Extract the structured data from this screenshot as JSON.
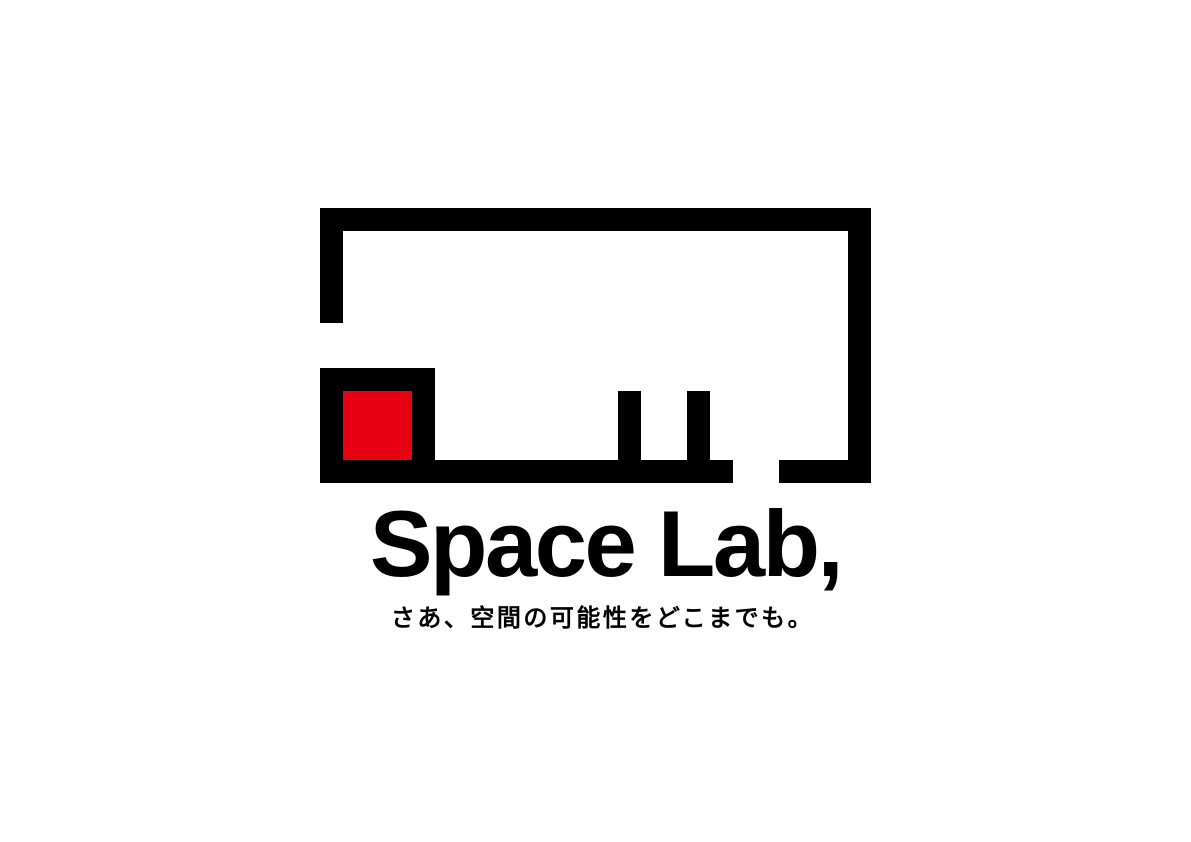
{
  "page": {
    "background_color": "#ffffff"
  },
  "logo": {
    "wordmark": "Space Lab,",
    "tagline": "さあ、空間の可能性をどこまでも。",
    "colors": {
      "ink": "#000000",
      "accent": "#e60012"
    },
    "mark": {
      "icon": "floorplan-room-icon",
      "elements": [
        "room-outline-with-door-openings",
        "red-square-room",
        "two-interior-wall-stubs"
      ]
    }
  }
}
